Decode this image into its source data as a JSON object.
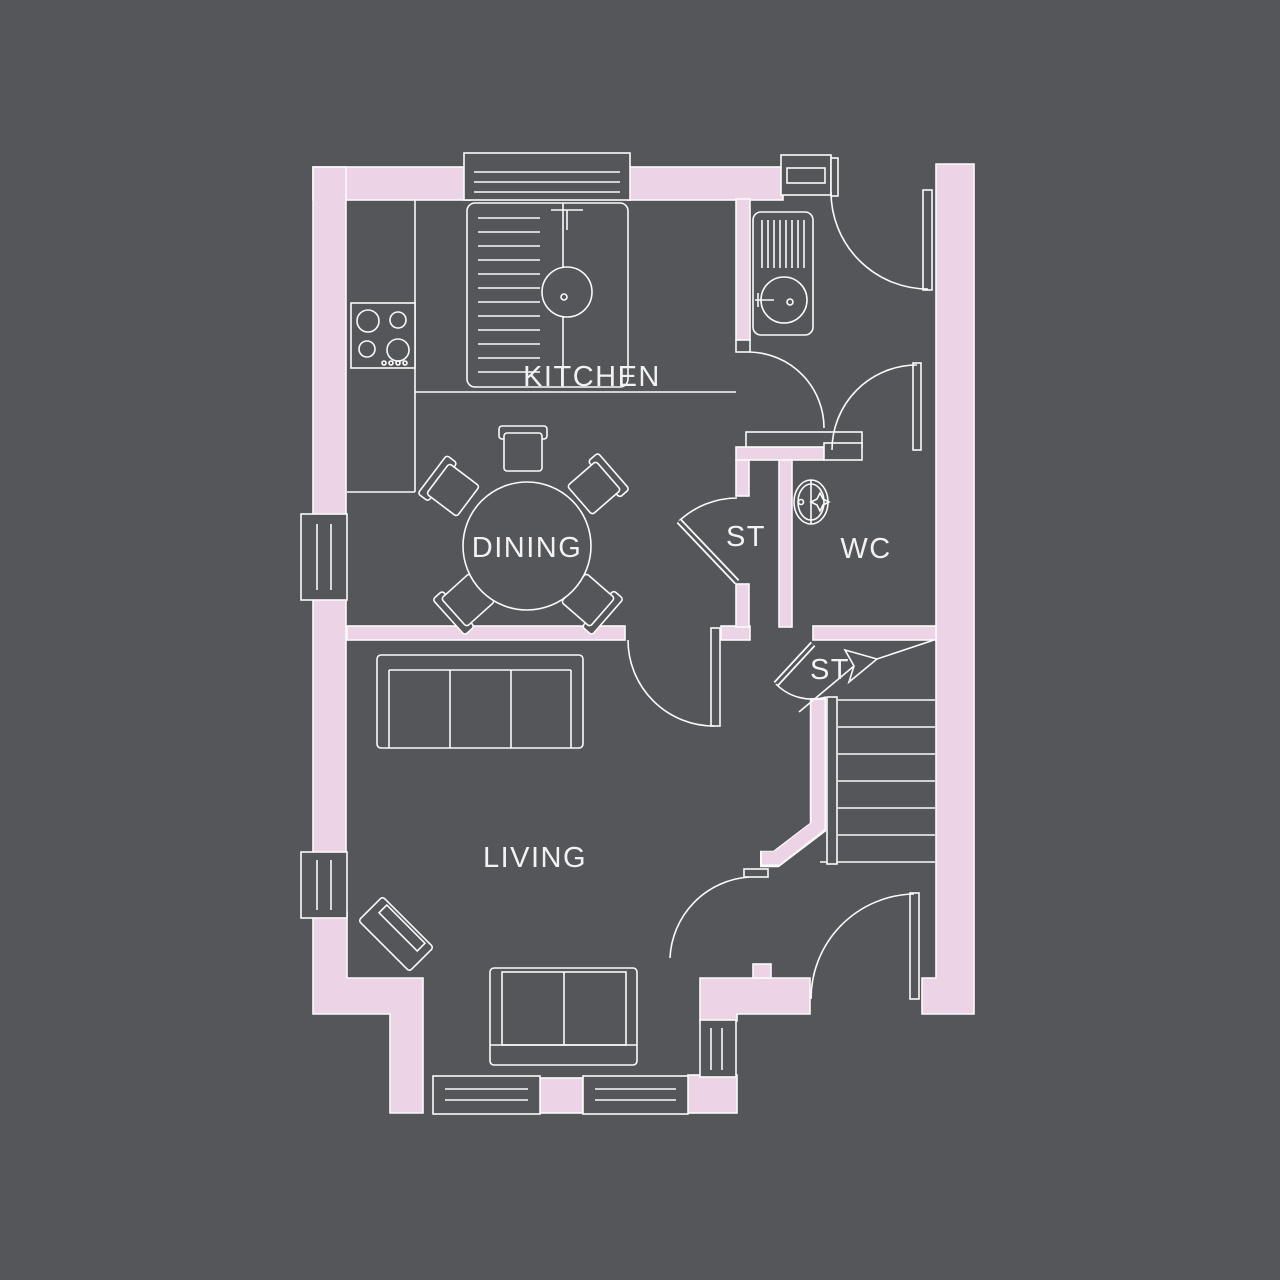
{
  "colors": {
    "background": "#55565a",
    "wall_fill": "#ecd4e6",
    "line": "#fafafa",
    "text": "#f2f2f2"
  },
  "rooms": {
    "kitchen": {
      "label": "KITCHEN"
    },
    "dining": {
      "label": "DINING"
    },
    "hall_storage": {
      "label": "ST"
    },
    "wc": {
      "label": "WC"
    },
    "stairs_storage": {
      "label": "ST"
    },
    "living": {
      "label": "LIVING"
    }
  },
  "fixtures": [
    "kitchen-sink-icon",
    "hob-icon",
    "hall-sink-icon",
    "wc-basin-icon",
    "dining-table-icon",
    "dining-chair-icon",
    "sofa-3-seat-icon",
    "sofa-2-seat-icon",
    "corner-tv-unit-icon",
    "staircase-icon",
    "stairs-up-arrow-icon",
    "door-swing-icon",
    "window-icon"
  ]
}
